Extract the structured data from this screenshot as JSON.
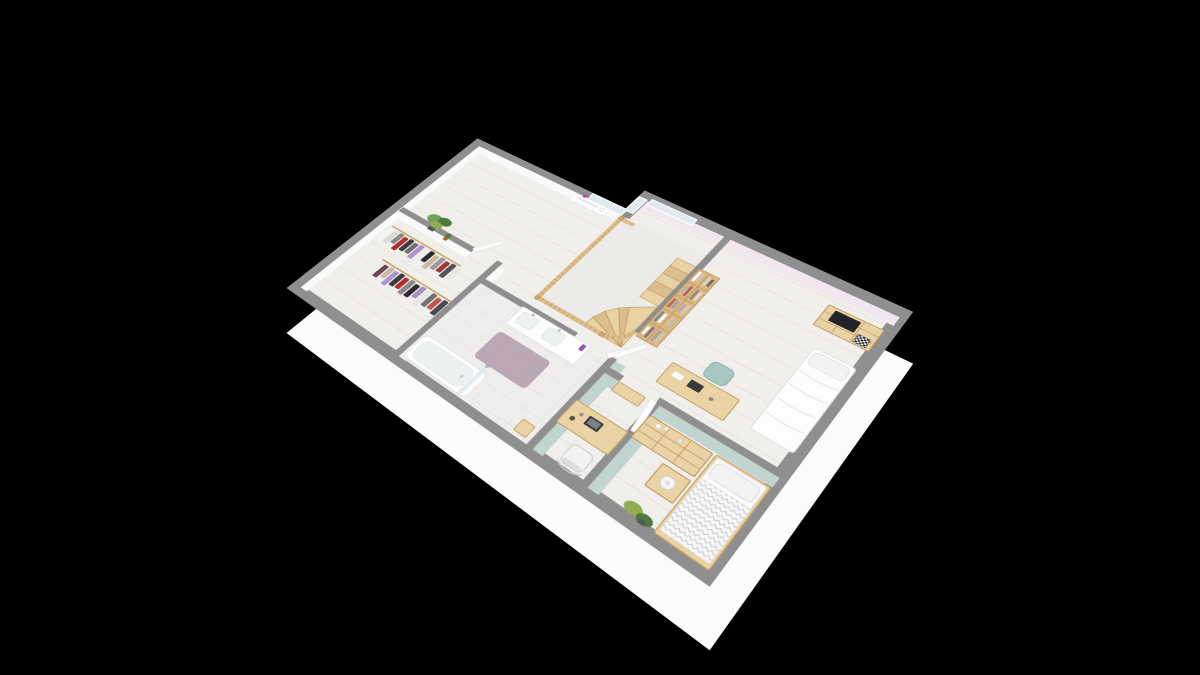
{
  "scene": {
    "description": "Isometric 3D dollhouse-style floor plan of an upper storey rendered on a black background",
    "view": "isometric cutaway from south-west, walls cut at ~1.1m",
    "background_color": "#000000"
  },
  "palette": {
    "bg": "#000000",
    "wall_top": "#8f8f8f",
    "wall_top_dark": "#848484",
    "slab": "#fbfbfb",
    "floor": "#f1efec",
    "floor_stair": "#edebe8",
    "tile": "#efeeec",
    "white_wall": "#fafafa",
    "pink_wall": "#f2e6ef",
    "mint_wall": "#c2d4d0",
    "window_glass": "#dfe9ee",
    "window_frame": "#ffffff",
    "wood_light": "#e9d2a4",
    "wood_mid": "#d9b884",
    "wood_dark": "#c9a368",
    "wood_line": "#c19a5f",
    "railing_wood": "#dcbd8d",
    "white_furniture": "#fdfdfd",
    "white_edge": "#e2e2e2",
    "basin": "#eef1f1",
    "rug_mauve": "#b5a3b0",
    "teal_chair": "#a7c8c1",
    "teal_chair_edge": "#8fb3ab",
    "tv_black": "#242428",
    "lamp_white": "#f6f6f6",
    "orchid_purple": "#b33fb0",
    "bottle_purple": "#9b4fb5",
    "plant_green": "#6fa15c",
    "plant_dark": "#4c7a3f",
    "plant_light": "#8fae4f",
    "pot_dark": "#565656",
    "pot_terracotta": "#b0622a",
    "duvet_line": "#c9c9ce",
    "rail_line": "#c9a96a",
    "laptop_dark": "#3a3a3e"
  },
  "rooms": [
    {
      "name": "hallway-landing",
      "furniture": [
        "console-table",
        "orchid",
        "potted-plant",
        "staircase",
        "wooden-railing",
        "windows"
      ]
    },
    {
      "name": "walk-in-closet",
      "furniture": [
        "clothes-rack-row-1",
        "clothes-rack-row-2"
      ]
    },
    {
      "name": "bathroom",
      "furniture": [
        "bathtub",
        "shower-screen",
        "double-sink-vanity",
        "bath-mat",
        "tiled-floor",
        "wooden-stool"
      ]
    },
    {
      "name": "study-nook",
      "furniture": [
        "desk",
        "laptop",
        "office-chair",
        "wall-shelf"
      ]
    },
    {
      "name": "bedroom-east",
      "furniture": [
        "bookshelf",
        "desk",
        "chair",
        "chest-of-drawers",
        "tv",
        "chessboard",
        "bed"
      ]
    },
    {
      "name": "bedroom-south",
      "furniture": [
        "chest-of-drawers",
        "nightstand",
        "table-lamp",
        "bed",
        "corner-plants"
      ]
    }
  ],
  "closet_clothes": {
    "row1": [
      "#f4f4f4",
      "#d8d8d8",
      "#8a8a8a",
      "#b03030",
      "#3d3a3e",
      "#6f6f72",
      "#b092cc",
      "#f0eee9",
      "#2e2b30",
      "#cbb9a2",
      "#9b9ba0",
      "#a23a3a",
      "#555258",
      "#e8e6e2"
    ],
    "row2": [
      "#efeeea",
      "#6d4457",
      "#cbb9a2",
      "#b092cc",
      "#3d3a3e",
      "#b03030",
      "#8a8a8a",
      "#2e2b30",
      "#a98fc5",
      "#e8e6e2",
      "#756f76",
      "#c2574c",
      "#4a4750"
    ]
  },
  "bookshelf_books": [
    "#ffffff",
    "#d8d3c8",
    "#b7b2ab",
    "#8f8a84",
    "#c06060",
    "#caa0b8",
    "#7d88a0",
    "#d4c09a",
    "#ffffff",
    "#a8a39c",
    "#c9c4bb",
    "#6d6862",
    "#b65c6e",
    "#e4ded4",
    "#97a2b5",
    "#d0cabf",
    "#ffffff",
    "#beb8ae",
    "#8c6f80",
    "#ccc6bc"
  ]
}
